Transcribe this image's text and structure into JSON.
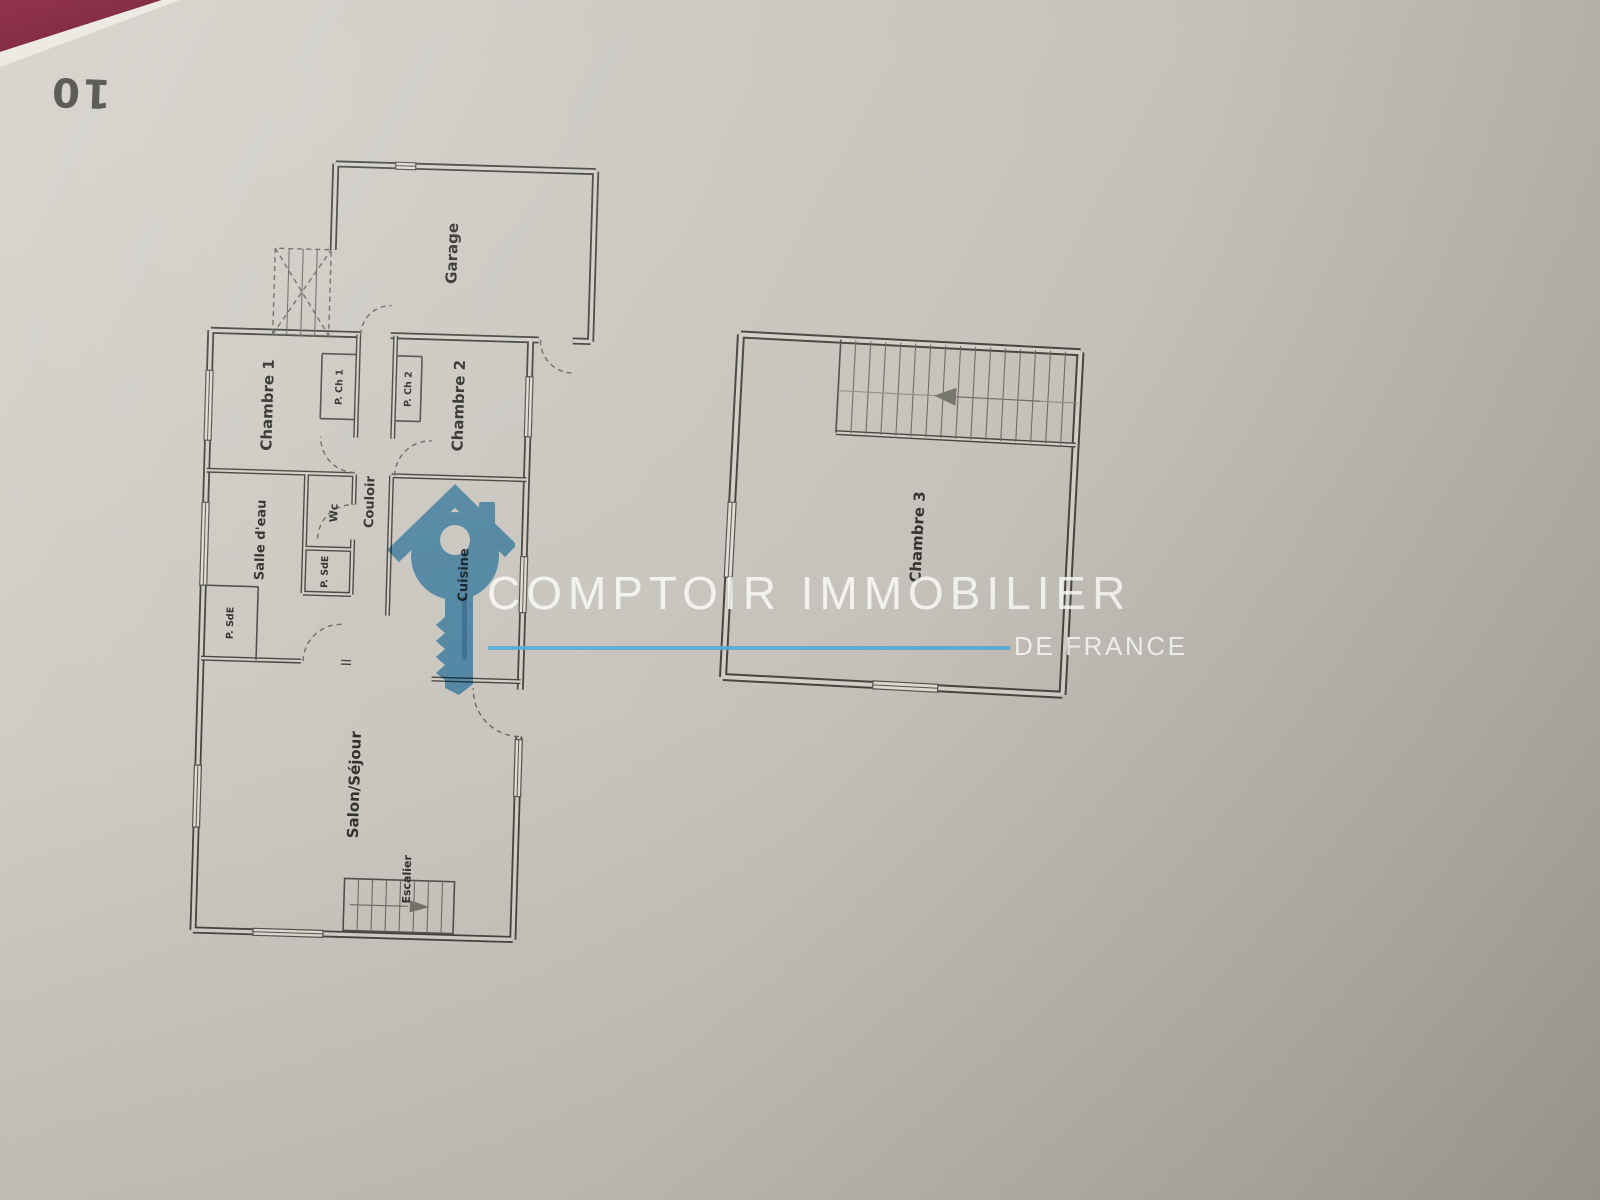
{
  "page": {
    "number": "10"
  },
  "watermark": {
    "brand": "COMPTOIR IMMOBILIER",
    "subtitle": "DE FRANCE",
    "accent_color": "#58a9d9",
    "logo": "house-key-icon"
  },
  "palette": {
    "paper": "#c9c6bf",
    "fabric": "#7a1c33",
    "wall_ink": "#46463f",
    "label_ink": "#33322d"
  },
  "floorplans": {
    "ground": {
      "labels": {
        "garage": "Garage",
        "chambre1": "Chambre 1",
        "p_ch1": "P. Ch 1",
        "p_ch2": "P. Ch 2",
        "chambre2": "Chambre 2",
        "couloir": "Couloir",
        "wc": "Wc",
        "salle_deau": "Salle d'eau",
        "p_sde_a": "P. SdE",
        "p_sde_b": "P. SdE",
        "cuisine": "Cuisine",
        "salon": "Salon/Séjour",
        "escalier": "Escalier"
      }
    },
    "upper": {
      "labels": {
        "chambre3": "Chambre 3"
      }
    }
  }
}
